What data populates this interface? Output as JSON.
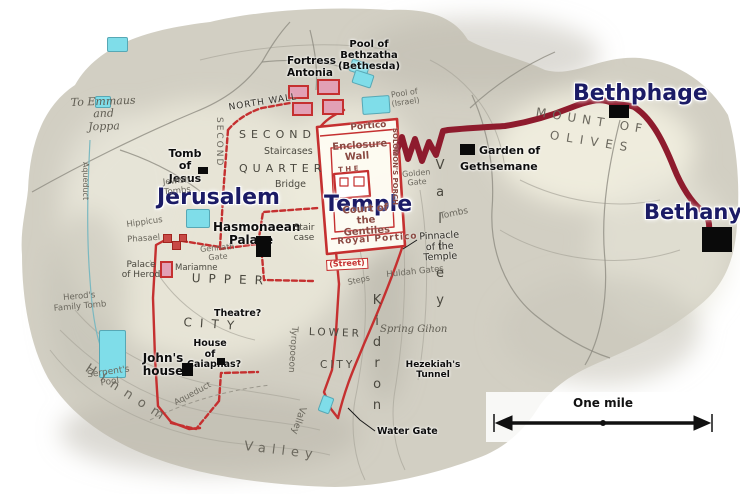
{
  "colors": {
    "navy": "#1b1b66",
    "wall": "#c53030",
    "route": "#8e1b2d",
    "pool": "#7fdde9",
    "poolBorder": "#57a8b5",
    "tower": "#e2a0b5",
    "terrain": "#d2cfc3"
  },
  "scale_bar": {
    "label": "One mile"
  },
  "map": {
    "labels": [
      {
        "name": "jerusalem",
        "text": "Jerusalem",
        "x": 157,
        "y": 186,
        "cls": "big",
        "fs": 22
      },
      {
        "name": "temple",
        "text": "Temple",
        "x": 324,
        "y": 193,
        "cls": "big",
        "fs": 22
      },
      {
        "name": "bethphage",
        "text": "Bethphage",
        "x": 573,
        "y": 82,
        "cls": "big",
        "fs": 22
      },
      {
        "name": "bethany",
        "text": "Bethany",
        "x": 644,
        "y": 201,
        "cls": "big",
        "fs": 21
      },
      {
        "name": "fortress-antonia",
        "text": "Fortress\nAntonia",
        "x": 287,
        "y": 56,
        "cls": "blk",
        "fs": 10.5
      },
      {
        "name": "pool-of-bethzatha",
        "text": "Pool of Bethzatha\n(Bethesda)",
        "x": 323,
        "y": 39,
        "cls": "blk",
        "fs": 10,
        "w": 92,
        "align": "center"
      },
      {
        "name": "tomb-of-jesus",
        "text": "Tomb of\nJesus",
        "x": 161,
        "y": 148,
        "cls": "blk",
        "fs": 11,
        "w": 48,
        "align": "center"
      },
      {
        "name": "hasmonaean-palace",
        "text": "Hasmonaean\nPalace",
        "x": 213,
        "y": 221,
        "cls": "blk",
        "fs": 12,
        "w": 76,
        "align": "center"
      },
      {
        "name": "garden-of",
        "text": "Garden of",
        "x": 479,
        "y": 145,
        "cls": "blk",
        "fs": 11
      },
      {
        "name": "gethsemane",
        "text": "Gethsemane",
        "x": 460,
        "y": 161,
        "cls": "blk",
        "fs": 11
      },
      {
        "name": "johns-house",
        "text": "John's\nhouse",
        "x": 140,
        "y": 352,
        "cls": "blk",
        "fs": 12,
        "w": 46,
        "align": "center"
      },
      {
        "name": "water-gate",
        "text": "Water Gate",
        "x": 377,
        "y": 427,
        "cls": "blk",
        "fs": 9.5
      },
      {
        "name": "hezekiahs-tunnel",
        "text": "Hezekiah's\nTunnel",
        "x": 402,
        "y": 360,
        "cls": "blk",
        "fs": 9,
        "w": 62,
        "align": "center"
      },
      {
        "name": "house-of-caiaphas",
        "text": "House of\nCaiaphas?",
        "x": 187,
        "y": 339,
        "cls": "blk",
        "fs": 9.5,
        "w": 46,
        "align": "center"
      },
      {
        "name": "theatre",
        "text": "Theatre?",
        "x": 214,
        "y": 309,
        "cls": "blk",
        "fs": 9.5
      },
      {
        "name": "portico-north",
        "text": "Portico",
        "x": 350,
        "y": 123,
        "cls": "tmpl",
        "fs": 9,
        "rot": -5
      },
      {
        "name": "enclosure-wall",
        "text": "Enclosure\nWall",
        "x": 332,
        "y": 142,
        "cls": "tmpl",
        "fs": 10,
        "w": 48,
        "align": "center",
        "rot": -4
      },
      {
        "name": "the-temple",
        "text": "T H E",
        "x": 338,
        "y": 167,
        "cls": "tmpl",
        "fs": 7,
        "rot": -4
      },
      {
        "name": "court-of-gentiles",
        "text": "Court of the\nGentiles",
        "x": 337,
        "y": 206,
        "cls": "tmpl",
        "fs": 10,
        "w": 56,
        "align": "center",
        "rot": -4
      },
      {
        "name": "royal-portico",
        "text": "Royal Portico",
        "x": 337,
        "y": 237,
        "cls": "tmpl",
        "fs": 9,
        "rot": -4,
        "ls": 1
      },
      {
        "name": "solomons-porch",
        "text": "SOLOMON'S PORCH",
        "x": 390,
        "y": 128,
        "cls": "tmpl vert",
        "fs": 7,
        "h": 108
      },
      {
        "name": "street",
        "text": "(Street)",
        "x": 326,
        "y": 260,
        "cls": "redbox lbl2",
        "fs": 8,
        "rot": -3
      },
      {
        "name": "north-wall",
        "text": "NORTH WALL",
        "x": 228,
        "y": 103,
        "cls": "smb",
        "fs": 9,
        "rot": -9,
        "ls": 1
      },
      {
        "name": "second-wall-vertical",
        "text": "SECOND",
        "x": 214,
        "y": 117,
        "cls": "gry vert",
        "fs": 9,
        "h": 64,
        "ls": 2
      },
      {
        "name": "second",
        "text": "SECOND",
        "x": 239,
        "y": 129,
        "cls": "gryd",
        "fs": 11,
        "ls": 5
      },
      {
        "name": "quarter",
        "text": "QUARTER",
        "x": 239,
        "y": 163,
        "cls": "gryd",
        "fs": 11,
        "ls": 5
      },
      {
        "name": "staircases",
        "text": "Staircases",
        "x": 264,
        "y": 147,
        "cls": "gryd",
        "fs": 9.5
      },
      {
        "name": "bridge",
        "text": "Bridge",
        "x": 275,
        "y": 180,
        "cls": "gryd",
        "fs": 9.5
      },
      {
        "name": "staircase",
        "text": "Stair\ncase",
        "x": 291,
        "y": 223,
        "cls": "gryd",
        "fs": 9,
        "w": 26,
        "align": "center"
      },
      {
        "name": "jewish-tombs",
        "text": "Jewish\nTombs",
        "x": 160,
        "y": 179,
        "cls": "gry",
        "fs": 8.5,
        "w": 32,
        "align": "center",
        "rot": -6
      },
      {
        "name": "hippicus",
        "text": "Hippicus",
        "x": 126,
        "y": 221,
        "cls": "gry",
        "fs": 8.5,
        "rot": -8
      },
      {
        "name": "phasael",
        "text": "Phasael",
        "x": 127,
        "y": 236,
        "cls": "gry",
        "fs": 8.5,
        "rot": -4
      },
      {
        "name": "mariamne",
        "text": "Mariamne",
        "x": 175,
        "y": 264,
        "cls": "gryd",
        "fs": 8.5
      },
      {
        "name": "palace-of-herod",
        "text": "Palace\nof Herod",
        "x": 118,
        "y": 260,
        "cls": "gryd",
        "fs": 9,
        "w": 46,
        "align": "center"
      },
      {
        "name": "gennath-gate",
        "text": "Gennath\nGate",
        "x": 199,
        "y": 246,
        "cls": "gry",
        "fs": 8,
        "w": 36,
        "align": "center",
        "rot": -5
      },
      {
        "name": "upper",
        "text": "UPPER",
        "x": 192,
        "y": 272,
        "cls": "gryd",
        "fs": 12,
        "ls": 8,
        "rot": 2
      },
      {
        "name": "city-upper",
        "text": "CITY",
        "x": 184,
        "y": 316,
        "cls": "gryd",
        "fs": 12,
        "ls": 8,
        "rot": 4
      },
      {
        "name": "lower",
        "text": "LOWER",
        "x": 309,
        "y": 327,
        "cls": "gryd",
        "fs": 10.5,
        "ls": 3,
        "rot": 2
      },
      {
        "name": "city-lower",
        "text": "CITY",
        "x": 320,
        "y": 360,
        "cls": "gryd",
        "fs": 10.5,
        "ls": 3
      },
      {
        "name": "steps",
        "text": "Steps",
        "x": 347,
        "y": 279,
        "cls": "gry",
        "fs": 8,
        "rot": -12
      },
      {
        "name": "huldah-gates",
        "text": "Huldah Gates",
        "x": 386,
        "y": 271,
        "cls": "gry",
        "fs": 8.5,
        "rot": -6
      },
      {
        "name": "pinnacle",
        "text": "Pinnacle\nof the Temple",
        "x": 410,
        "y": 233,
        "cls": "smb",
        "fs": 9.5,
        "w": 58,
        "align": "center",
        "rot": -3
      },
      {
        "name": "tombs",
        "text": "Tombs",
        "x": 439,
        "y": 212,
        "cls": "gry",
        "fs": 9,
        "rot": -12
      },
      {
        "name": "golden-gate",
        "text": "Golden\nGate",
        "x": 401,
        "y": 171,
        "cls": "gry",
        "fs": 8,
        "w": 30,
        "align": "center",
        "rot": -5
      },
      {
        "name": "herods-family-tomb",
        "text": "Herod's\nFamily Tomb",
        "x": 52,
        "y": 295,
        "cls": "gry",
        "fs": 8.5,
        "w": 54,
        "align": "center",
        "rot": -5
      },
      {
        "name": "serpents-pool",
        "text": "Serpent's\nPool",
        "x": 82,
        "y": 371,
        "cls": "gry",
        "fs": 9,
        "w": 52,
        "align": "center",
        "rot": -8
      },
      {
        "name": "aqueduct-west",
        "text": "Aqueduct",
        "x": 80,
        "y": 162,
        "cls": "gry vert",
        "fs": 8,
        "h": 56
      },
      {
        "name": "aqueduct-south",
        "text": "Aqueduct",
        "x": 173,
        "y": 400,
        "cls": "gry",
        "fs": 8.5,
        "rot": -28
      },
      {
        "name": "hinnom",
        "text": "Hinnom",
        "x": 90,
        "y": 362,
        "cls": "gry",
        "fs": 13,
        "ls": 8,
        "rot": 33
      },
      {
        "name": "valley-hinnom",
        "text": "Valley",
        "x": 245,
        "y": 440,
        "cls": "gry",
        "fs": 13,
        "ls": 6,
        "rot": 7
      },
      {
        "name": "tyropoeon",
        "text": "Tyropoeon",
        "x": 289,
        "y": 326,
        "cls": "gry vert",
        "fs": 9,
        "h": 94,
        "rot": 4
      },
      {
        "name": "valley-tyropoeon",
        "text": "Valley",
        "x": 297,
        "y": 405,
        "cls": "gry vert",
        "fs": 9.5,
        "h": 58,
        "rot": 18
      },
      {
        "name": "kidron",
        "text": "Kidron",
        "x": 369,
        "y": 293,
        "cls": "gryd vertu",
        "fs": 13,
        "h": 145,
        "ls": 6
      },
      {
        "name": "valley-kidron",
        "text": "Valley",
        "x": 432,
        "y": 158,
        "cls": "gryd vertu",
        "fs": 13,
        "h": 180,
        "ls": 12
      },
      {
        "name": "mount-of",
        "text": "MOUNT OF",
        "x": 537,
        "y": 106,
        "cls": "gry",
        "fs": 12,
        "ls": 6,
        "rot": 9
      },
      {
        "name": "olives",
        "text": "OLIVES",
        "x": 551,
        "y": 129,
        "cls": "gry",
        "fs": 12,
        "ls": 7,
        "rot": 9
      },
      {
        "name": "spring-gihon",
        "text": "Spring Gihon",
        "x": 380,
        "y": 324,
        "cls": "git",
        "fs": 10
      },
      {
        "name": "pool-of-israel",
        "text": "Pool of\n(Israel)",
        "x": 387,
        "y": 92,
        "cls": "gry",
        "fs": 8,
        "w": 34,
        "align": "center",
        "rot": -8
      },
      {
        "name": "to-emmaus-and-joppa",
        "text": "To Emmaus\nand\nJoppa",
        "x": 70,
        "y": 97,
        "cls": "git",
        "fs": 11,
        "w": 66,
        "align": "center",
        "rot": -2
      }
    ],
    "markers": [
      {
        "name": "tomb-of-jesus-marker",
        "x": 198,
        "y": 167,
        "w": 10,
        "h": 7
      },
      {
        "name": "hasmonaean-palace-marker",
        "x": 256,
        "y": 236,
        "w": 15,
        "h": 21
      },
      {
        "name": "gethsemane-marker",
        "x": 460,
        "y": 144,
        "w": 15,
        "h": 11
      },
      {
        "name": "bethphage-marker",
        "x": 609,
        "y": 105,
        "w": 20,
        "h": 13
      },
      {
        "name": "bethany-marker",
        "x": 702,
        "y": 227,
        "w": 30,
        "h": 25
      },
      {
        "name": "johns-house-marker",
        "x": 182,
        "y": 363,
        "w": 11,
        "h": 13
      },
      {
        "name": "caiaphas-marker",
        "x": 217,
        "y": 358,
        "w": 8,
        "h": 7
      }
    ],
    "pools": [
      {
        "name": "pond-northwest",
        "x": 107,
        "y": 37,
        "w": 19,
        "h": 13,
        "rot": 0
      },
      {
        "name": "pond-west",
        "x": 95,
        "y": 96,
        "w": 14,
        "h": 10,
        "rot": 0
      },
      {
        "name": "bethzatha-pool-north",
        "x": 350,
        "y": 61,
        "w": 17,
        "h": 11,
        "rot": 18
      },
      {
        "name": "bethzatha-pool-south",
        "x": 353,
        "y": 72,
        "w": 18,
        "h": 12,
        "rot": 18
      },
      {
        "name": "israel-pool",
        "x": 362,
        "y": 96,
        "w": 26,
        "h": 16,
        "rot": -4
      },
      {
        "name": "towers-pool",
        "x": 186,
        "y": 209,
        "w": 22,
        "h": 17,
        "rot": 0
      },
      {
        "name": "serpents-pool-water",
        "x": 99,
        "y": 330,
        "w": 25,
        "h": 46,
        "rot": 0
      },
      {
        "name": "siloam-pool",
        "x": 320,
        "y": 396,
        "w": 10,
        "h": 15,
        "rot": 20
      }
    ],
    "towers": [
      {
        "name": "antonia-tower-nw",
        "x": 288,
        "y": 85,
        "w": 21,
        "h": 14
      },
      {
        "name": "antonia-tower-ne",
        "x": 317,
        "y": 79,
        "w": 23,
        "h": 16
      },
      {
        "name": "antonia-tower-sw",
        "x": 292,
        "y": 102,
        "w": 21,
        "h": 14
      },
      {
        "name": "antonia-tower-se",
        "x": 322,
        "y": 99,
        "w": 22,
        "h": 16
      },
      {
        "name": "mariamne-tower",
        "x": 160,
        "y": 261,
        "w": 13,
        "h": 17
      },
      {
        "name": "hippicus-tower",
        "x": 163,
        "y": 234,
        "w": 9,
        "h": 9,
        "dark": true
      },
      {
        "name": "phasael-tower",
        "x": 172,
        "y": 241,
        "w": 9,
        "h": 9,
        "dark": true
      },
      {
        "name": "citadel-tower",
        "x": 179,
        "y": 234,
        "w": 8,
        "h": 8,
        "dark": true
      }
    ]
  }
}
